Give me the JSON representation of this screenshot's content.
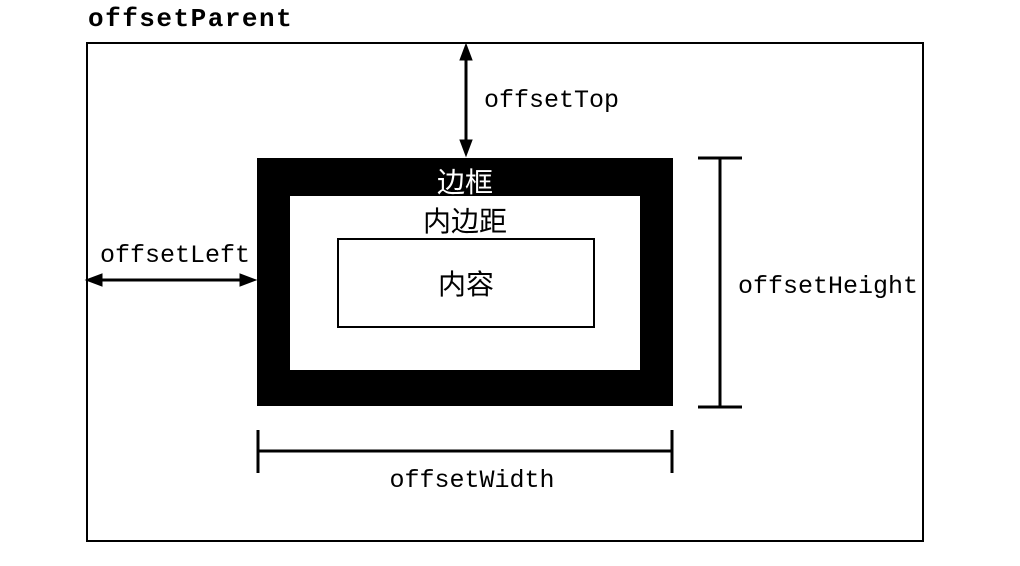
{
  "colors": {
    "ink": "#000000",
    "paper": "#ffffff",
    "border_box_fill": "#000000",
    "border_box_text": "#ffffff"
  },
  "diagram": {
    "title": "offsetParent",
    "measurements": {
      "offset_top": "offsetTop",
      "offset_left": "offsetLeft",
      "offset_height": "offsetHeight",
      "offset_width": "offsetWidth"
    },
    "boxes": {
      "border": "边框",
      "padding": "内边距",
      "content": "内容"
    }
  }
}
